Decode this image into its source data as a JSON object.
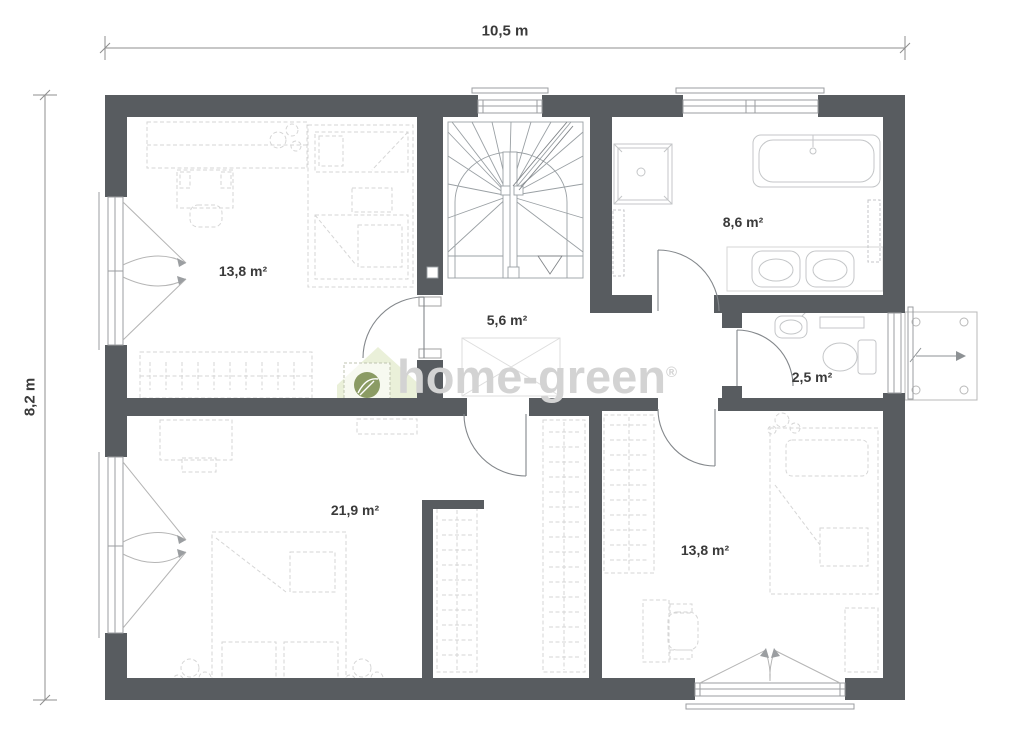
{
  "dimensions": {
    "width_label": "10,5 m",
    "height_label": "8,2 m"
  },
  "rooms": [
    {
      "id": "bedroom-top-left",
      "area": "13,8 m²"
    },
    {
      "id": "bathroom",
      "area": "8,6 m²"
    },
    {
      "id": "hallway",
      "area": "5,6 m²"
    },
    {
      "id": "wc",
      "area": "2,5 m²"
    },
    {
      "id": "bedroom-bottom-left",
      "area": "21,9 m²"
    },
    {
      "id": "bedroom-bottom-right",
      "area": "13,8 m²"
    }
  ],
  "watermark": {
    "brand": "home-green",
    "registered": "®"
  },
  "colors": {
    "background": "#ffffff",
    "wall": "#585c60",
    "line": "#9b9ea1",
    "stair": "#9aa0a4",
    "furniture": "#d6d6d6",
    "fixture": "#c4c6c8",
    "dim": "#8f8f8f",
    "label": "#3a3a3a",
    "watermark_text": "#d3d3d3",
    "watermark_house": "#e6edd2",
    "watermark_leaf": "#8b9b64"
  }
}
